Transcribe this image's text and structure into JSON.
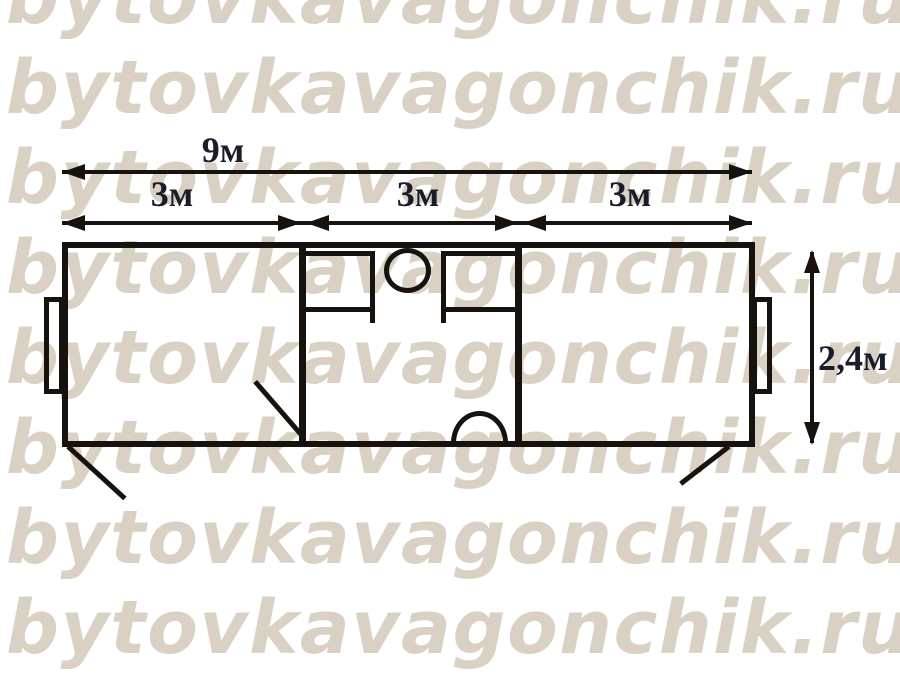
{
  "watermark": {
    "text": "bytovkavagonchik.ru",
    "rows": 8,
    "color": "#d8d1c4"
  },
  "diagram": {
    "type": "floor-plan",
    "subject": "portable cabin (bytovka) 9m x 2.4m with three 3m sections"
  },
  "dimensions": {
    "total_length": {
      "label": "9м"
    },
    "sections": [
      {
        "label": "3м"
      },
      {
        "label": "3м"
      },
      {
        "label": "3м"
      }
    ],
    "height": {
      "label": "2,4м"
    }
  },
  "colors": {
    "background": "#ffffff",
    "line": "#17120d",
    "dimension_text": "#1c1b2c",
    "watermark": "#d8d1c4"
  }
}
